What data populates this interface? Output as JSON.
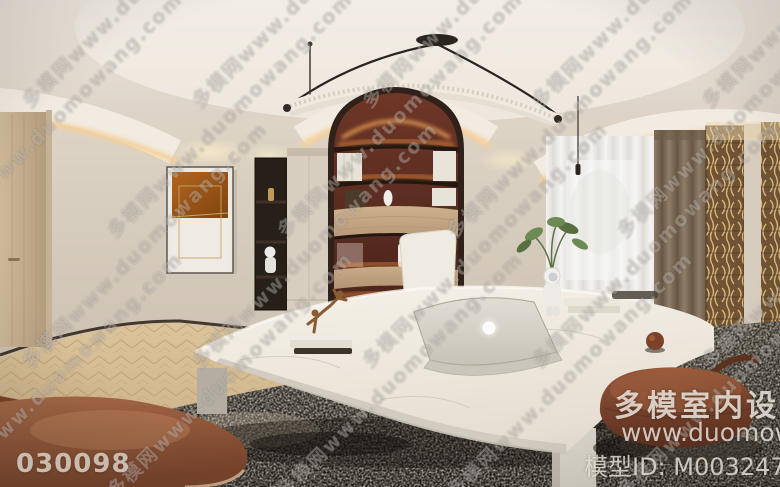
{
  "watermark": {
    "tile_text": "多模网www.duomowang.com"
  },
  "footer": {
    "left_id": "030098",
    "brand": "多模室内设计",
    "url": "www.duomowang",
    "model_id": "模型ID: M0032470"
  },
  "scene": {
    "description": "360-degree equirectangular panorama render of a modern home office study",
    "objects": [
      "ceiling-cove-lighting",
      "pendant-tube-light",
      "arched-bookshelf",
      "wood-cabinet-doors",
      "abstract-artwork",
      "entry-door",
      "display-niche",
      "window-sheer-curtain",
      "brown-drape",
      "gold-carved-panels",
      "curved-marble-desk",
      "laptop",
      "office-chair",
      "bronze-sculpture",
      "astronaut-figurine",
      "green-plant",
      "book-stacks",
      "area-rug",
      "herringbone-floor",
      "leather-seat",
      "leather-pouf"
    ],
    "colors": {
      "ceiling": "#ece5dc",
      "wall": "#d8cfc2",
      "cove_glow": "#f6cf96",
      "shelf_back": "#5d2c21",
      "shelf_led": "#ffb25e",
      "wood": "#c9ae8a",
      "artwork_orange": "#b4651f",
      "sheer": "#f2f1ef",
      "drape": "#8f7e68",
      "gold_panel": "#6f5334",
      "desk_marble": "#f1ece4",
      "rug_dark": "#2a251f",
      "floor": "#d6bd95",
      "leather": "#9a5f40",
      "pouf": "#82492f"
    }
  }
}
